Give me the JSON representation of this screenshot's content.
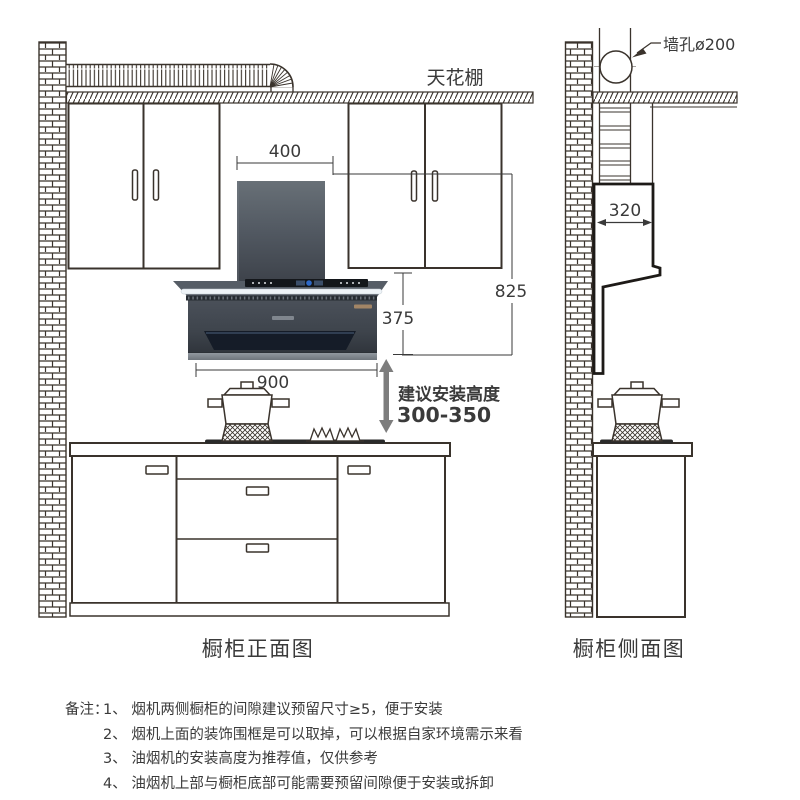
{
  "front_view": {
    "caption": "橱柜正面图",
    "ceiling_label": "天花棚",
    "dimensions": {
      "hood_top_width": "400",
      "overall_height": "825",
      "hood_body_height": "375",
      "hood_width": "900",
      "base_cabinet_height": "800-850"
    },
    "install_height": {
      "label": "建议安装高度",
      "value": "300-350"
    }
  },
  "side_view": {
    "caption": "橱柜侧面图",
    "wall_hole_label": "墙孔ø200",
    "dimensions": {
      "hood_depth": "320"
    }
  },
  "notes": {
    "label": "备注：",
    "items": [
      "1、 烟机两侧橱柜的间隙建议预留尺寸≥5，便于安装",
      "2、 烟机上面的装饰围框是可以取掉，可以根据自家环境需示来看",
      "3、 油烟机的安装高度为推荐值，仅供参考",
      "4、 油烟机上部与橱柜底部可能需要预留间隙便于安装或拆卸"
    ]
  },
  "colors": {
    "line": "#3a332c",
    "dimension_text": "#3a3a3a",
    "install_arrow": "#7d7d7d",
    "hood_body_dark": "#3f444c",
    "hood_light_strip": "#eef3f7"
  }
}
